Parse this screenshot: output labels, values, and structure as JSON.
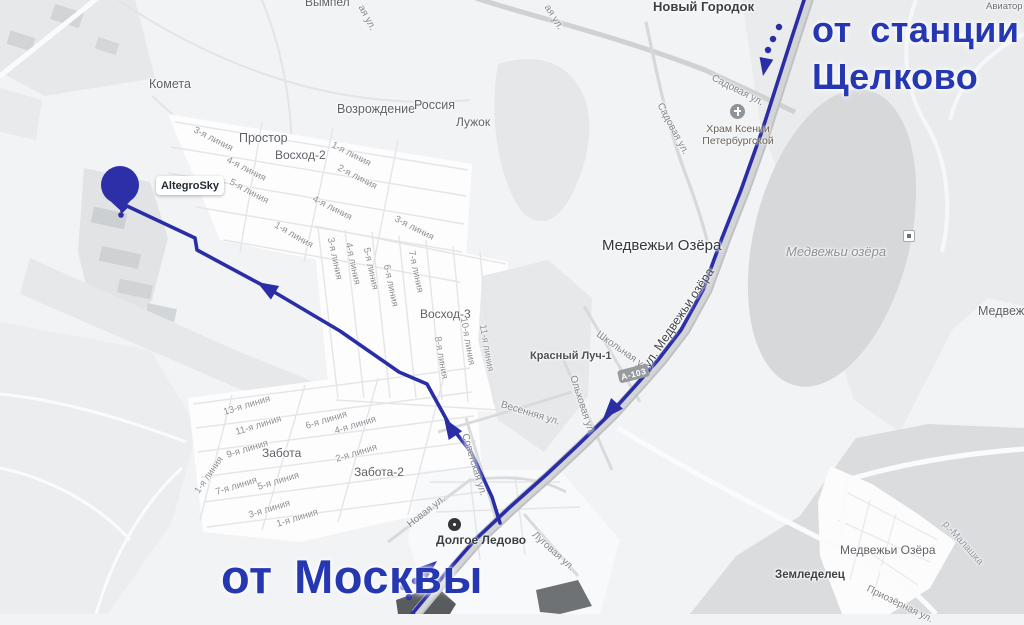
{
  "colors": {
    "annotation": "#2637b2",
    "route": "#2a2ea6",
    "marker": "#2c2fa8"
  },
  "annotations": {
    "from_station_line1": "от станции",
    "from_station_line2": "Щелково",
    "from_moscow": "от Москвы"
  },
  "marker": {
    "label": "AltegroSky"
  },
  "road_shield": {
    "label": "А-103"
  },
  "pois": {
    "church": {
      "line1": "Храм Ксении",
      "line2": "Петербургской"
    },
    "village_point": {
      "label": "Долгое Ледово"
    }
  },
  "map": {
    "settlements": [
      {
        "text": "Вымпел",
        "x": 305,
        "y": -4
      },
      {
        "text": "Новый Городок",
        "x": 653,
        "y": 0,
        "s": 13,
        "w": 600,
        "c": "#3e4247"
      },
      {
        "text": "Авиатор",
        "x": 986,
        "y": 2,
        "s": 9.5,
        "c": "#6d7175"
      },
      {
        "text": "Простор",
        "x": 239,
        "y": 132,
        "s": 12.5
      },
      {
        "text": "Комета",
        "x": 149,
        "y": 78,
        "s": 12.5
      },
      {
        "text": "Возрождение",
        "x": 337,
        "y": 103,
        "s": 12.5
      },
      {
        "text": "Россия",
        "x": 414,
        "y": 99,
        "s": 12.5
      },
      {
        "text": "Лужок",
        "x": 456,
        "y": 116,
        "s": 12
      },
      {
        "text": "Восход-2",
        "x": 275,
        "y": 149,
        "s": 12
      },
      {
        "text": "Восход-3",
        "x": 420,
        "y": 308,
        "s": 12
      },
      {
        "text": "Медвежьи Озёра",
        "x": 602,
        "y": 238,
        "s": 15,
        "w": 500,
        "c": "#34383c"
      },
      {
        "text": "Красный Луч-1",
        "x": 530,
        "y": 351,
        "s": 11,
        "w": 600,
        "c": "#4e5256"
      },
      {
        "text": "Забота",
        "x": 262,
        "y": 447,
        "s": 12
      },
      {
        "text": "Забота-2",
        "x": 354,
        "y": 466,
        "s": 12
      },
      {
        "text": "Земледелец",
        "x": 775,
        "y": 570,
        "s": 11.5,
        "w": 700,
        "c": "#3e4247"
      },
      {
        "text": "Медвежьи Озёра",
        "x": 840,
        "y": 544,
        "s": 12
      },
      {
        "text": "Медвежьи Озёра",
        "x": 978,
        "y": 305,
        "s": 12.5
      }
    ],
    "streets": [
      {
        "text": "Садовая ул.",
        "x": 712,
        "y": 73,
        "r": 27
      },
      {
        "text": "Садовая ул.",
        "x": 659,
        "y": 99,
        "r": 62
      },
      {
        "text": "ул. Медвежьи озёра",
        "x": 646,
        "y": 360,
        "r": -56,
        "s": 12.5,
        "w": 500,
        "c": "#44484c"
      },
      {
        "text": "Школьная ул.",
        "x": 597,
        "y": 329,
        "r": 35
      },
      {
        "text": "Ольховая ул.",
        "x": 572,
        "y": 371,
        "r": 72
      },
      {
        "text": "Весенняя ул.",
        "x": 501,
        "y": 400,
        "r": 17
      },
      {
        "text": "Советская ул.",
        "x": 464,
        "y": 429,
        "r": 73
      },
      {
        "text": "Новая ул.",
        "x": 409,
        "y": 521,
        "r": -38
      },
      {
        "text": "Луговая ул.",
        "x": 533,
        "y": 529,
        "r": 42
      },
      {
        "text": "Приозёрная ул.",
        "x": 867,
        "y": 584,
        "r": 26
      },
      {
        "text": "р.-Малашка",
        "x": 944,
        "y": 518,
        "r": 48,
        "c": "#8e97a1"
      },
      {
        "text": "ая ул.",
        "x": 360,
        "y": 1,
        "r": 62
      },
      {
        "text": "ая ул.",
        "x": 546,
        "y": 1,
        "r": 58
      }
    ],
    "line_streets": [
      {
        "text": "3-я линия",
        "x": 194,
        "y": 125,
        "r": 27
      },
      {
        "text": "4-я линия",
        "x": 227,
        "y": 155,
        "r": 27
      },
      {
        "text": "5-я линия",
        "x": 230,
        "y": 177,
        "r": 28
      },
      {
        "text": "1-я линия",
        "x": 332,
        "y": 140,
        "r": 27
      },
      {
        "text": "2-я линия",
        "x": 338,
        "y": 163,
        "r": 27
      },
      {
        "text": "4-я линия",
        "x": 313,
        "y": 194,
        "r": 27
      },
      {
        "text": "3-я линия",
        "x": 395,
        "y": 214,
        "r": 27
      },
      {
        "text": "1-я линия",
        "x": 275,
        "y": 220,
        "r": 30
      },
      {
        "text": "3-я линия",
        "x": 330,
        "y": 233,
        "r": 78
      },
      {
        "text": "4-я линия",
        "x": 348,
        "y": 238,
        "r": 78
      },
      {
        "text": "5-я линия",
        "x": 366,
        "y": 243,
        "r": 78
      },
      {
        "text": "6-я линия",
        "x": 386,
        "y": 260,
        "r": 78
      },
      {
        "text": "7-я линия",
        "x": 411,
        "y": 246,
        "r": 78
      },
      {
        "text": "8-я линия",
        "x": 437,
        "y": 332,
        "r": 80
      },
      {
        "text": "10-я линия",
        "x": 463,
        "y": 313,
        "r": 80
      },
      {
        "text": "11-я линия",
        "x": 482,
        "y": 320,
        "r": 80
      },
      {
        "text": "13-я линия",
        "x": 224,
        "y": 408,
        "r": -17
      },
      {
        "text": "11-я линия",
        "x": 236,
        "y": 428,
        "r": -17
      },
      {
        "text": "9-я линия",
        "x": 227,
        "y": 451,
        "r": -17
      },
      {
        "text": "7-я линия",
        "x": 216,
        "y": 488,
        "r": -17
      },
      {
        "text": "1-я линия",
        "x": 197,
        "y": 488,
        "r": -55
      },
      {
        "text": "5-я линия",
        "x": 258,
        "y": 483,
        "r": -17
      },
      {
        "text": "3-я линия",
        "x": 249,
        "y": 511,
        "r": -17
      },
      {
        "text": "1-я линия",
        "x": 277,
        "y": 520,
        "r": -17
      },
      {
        "text": "6-я линия",
        "x": 306,
        "y": 422,
        "r": -17
      },
      {
        "text": "4-я линия",
        "x": 335,
        "y": 427,
        "r": -17
      },
      {
        "text": "2-я линия",
        "x": 336,
        "y": 455,
        "r": -17
      }
    ],
    "water": [
      {
        "text": "Медвежьи озёра",
        "x": 786,
        "y": 245,
        "s": 13
      }
    ]
  }
}
